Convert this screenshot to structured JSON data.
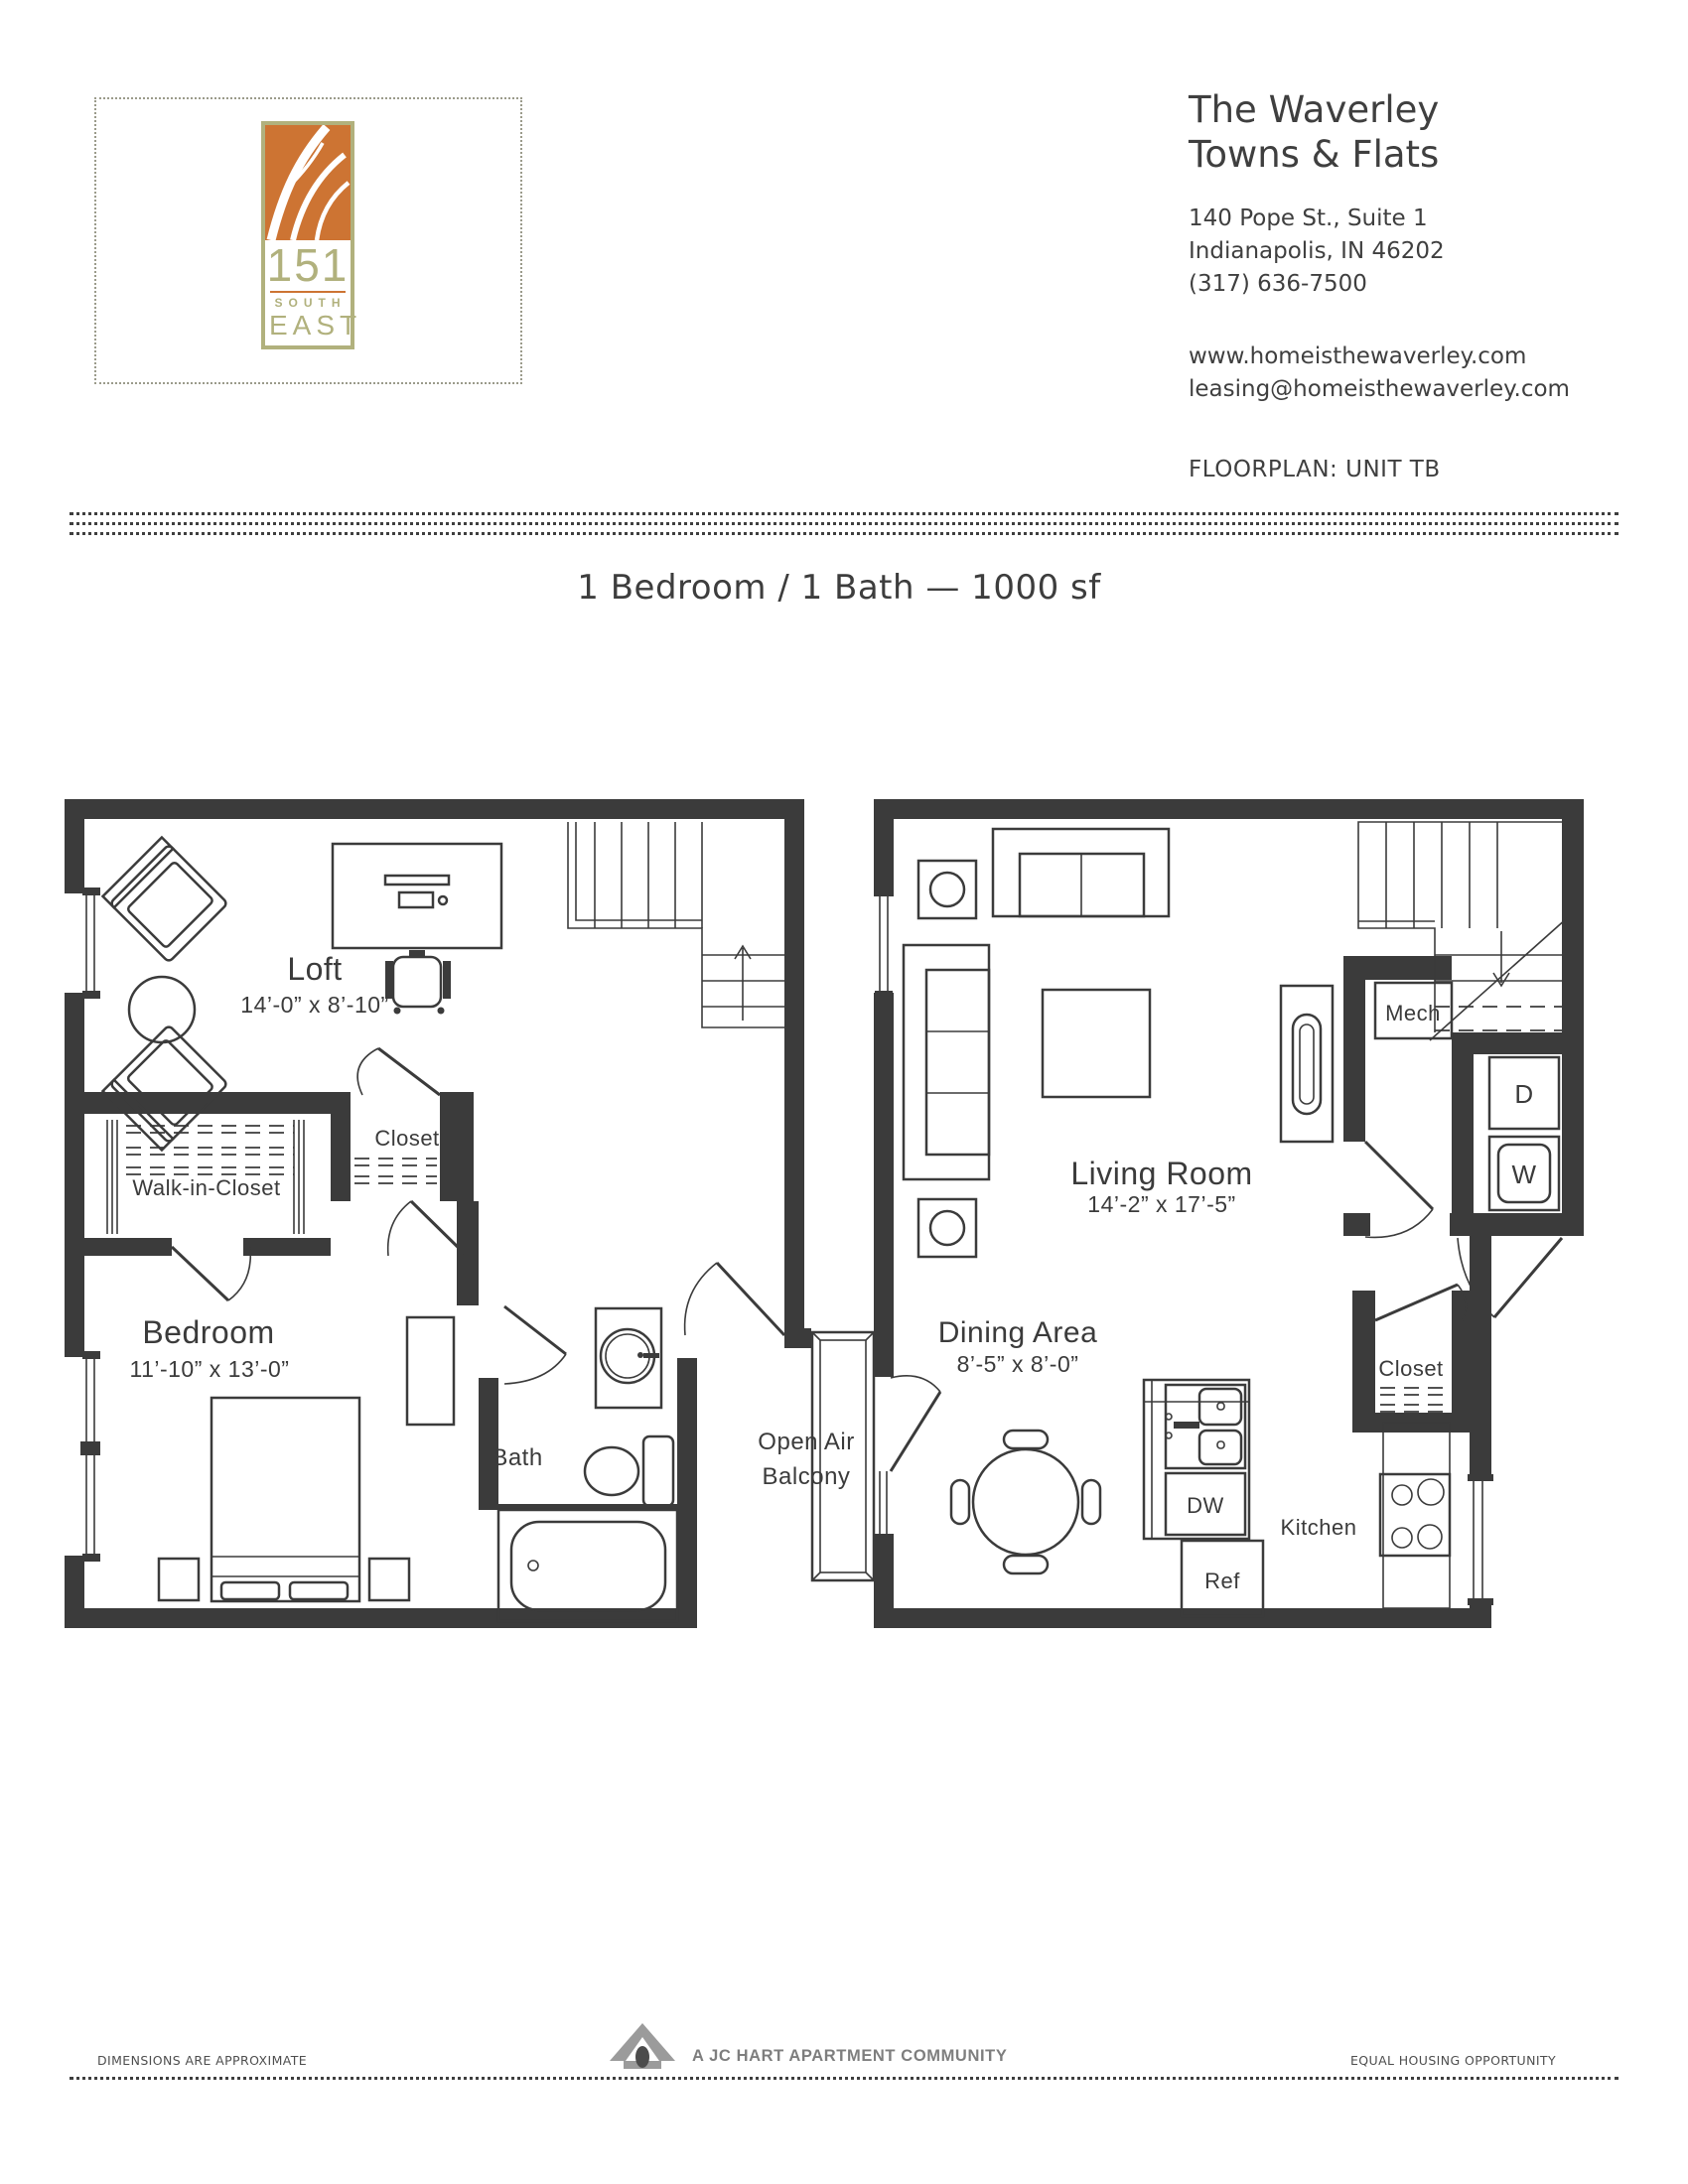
{
  "colors": {
    "ink": "#3b3b3b",
    "wall": "#3b3b3b",
    "logo_orange": "#cd7433",
    "logo_olive": "#b1b17d",
    "footer_gray": "#7e7e7e"
  },
  "logo": {
    "number": "151",
    "word1": "SOUTH",
    "word2": "EAST"
  },
  "header": {
    "brand_line1": "The Waverley",
    "brand_line2": "Towns & Flats",
    "address_line1": "140 Pope St., Suite 1",
    "address_line2": "Indianapolis, IN 46202",
    "phone": "(317) 636-7500",
    "website": "www.homeisthewaverley.com",
    "email": "leasing@homeisthewaverley.com",
    "floorplan_label": "FLOORPLAN: UNIT TB"
  },
  "title": "1 Bedroom / 1 Bath — 1000 sf",
  "floorplan": {
    "upper": {
      "room": "Loft",
      "room_dim": "14’-0” x 8’-10”",
      "closet": "Closet",
      "walk_in_closet": "Walk-in-Closet",
      "bedroom": "Bedroom",
      "bedroom_dim": "11’-10” x 13’-0”",
      "bath": "Bath"
    },
    "balcony_line1": "Open Air",
    "balcony_line2": "Balcony",
    "main": {
      "living": "Living Room",
      "living_dim": "14’-2” x 17’-5”",
      "dining": "Dining Area",
      "dining_dim": "8’-5” x 8’-0”",
      "mech": "Mech",
      "dryer": "D",
      "washer": "W",
      "closet": "Closet",
      "dishwasher": "DW",
      "refrigerator": "Ref",
      "kitchen": "Kitchen"
    }
  },
  "footer": {
    "left": "DIMENSIONS ARE APPROXIMATE",
    "center": "A JC HART APARTMENT COMMUNITY",
    "right": "EQUAL HOUSING OPPORTUNITY"
  }
}
